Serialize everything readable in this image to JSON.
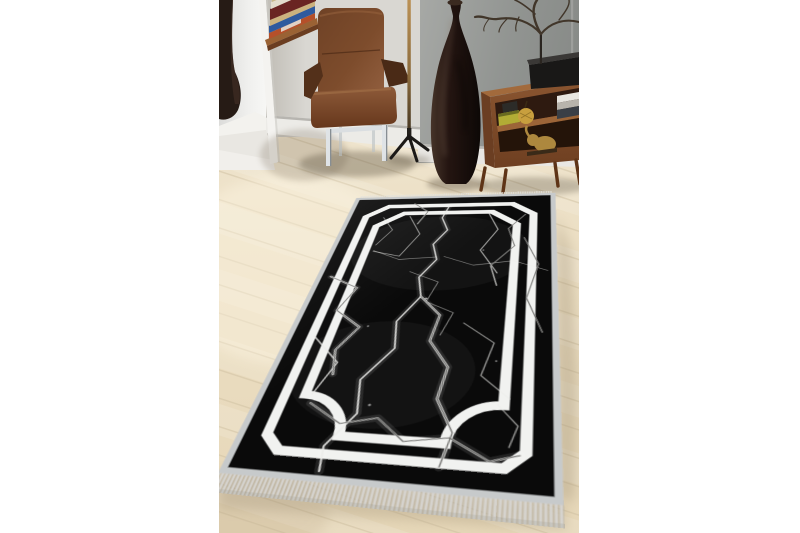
{
  "canvas": {
    "width": 800,
    "height": 533,
    "background": "#ffffff"
  },
  "photo": {
    "left": 219,
    "top": 0,
    "width": 360,
    "height": 533,
    "alt": "Black marble-pattern area rug with white double frame border and fringed ends, staged in a modern living room"
  },
  "palette": {
    "floor": "#e9dcbf",
    "floor_light": "#f2ebdb",
    "floor_seam": "#cfc1a2",
    "wall_back": "#d9d7d2",
    "wall_gray": "#8f928f",
    "wall_gray_light": "#a7a9a6",
    "window_light": "#f6f6f4",
    "white_wall": "#e9e7e2",
    "baseboard": "#efede9",
    "rug_black": "#0a0a0a",
    "rug_white": "#f1f2f0",
    "rug_binding": "#c7cacb",
    "fringe": "#d5d3cf",
    "leather": "#7c4c2d",
    "leather_dark": "#4a2b17",
    "chrome": "#dfe3e6",
    "wood": "#7d4a29",
    "wood_top": "#a26a3c",
    "floor_vase": "#1f1310",
    "brass": "#b08a50",
    "gold_decor": "#c89f3e"
  },
  "scene": {
    "objects": [
      {
        "name": "window-with-dark-vase",
        "label": "Bright window niche with dark decorative vase on white sill"
      },
      {
        "name": "wall-desk-with-books",
        "label": "Wall-mounted wooden desk with stacked books"
      },
      {
        "name": "leather-armchair",
        "label": "Brown leather armchair with chrome legs"
      },
      {
        "name": "floor-lamp-stand",
        "label": "Brass pole floor lamp with black tripod base"
      },
      {
        "name": "floor-vase",
        "label": "Tall dark bottle-shaped floor vase"
      },
      {
        "name": "branch-sculpture",
        "label": "Dry branch sculpture on a stand atop a black base"
      },
      {
        "name": "sideboard",
        "label": "Mid-century walnut sideboard with gold pear, box, books and elephant figurine"
      },
      {
        "name": "wood-floor",
        "label": "Light oak plank flooring laid diagonally"
      },
      {
        "name": "area-rug",
        "label": "Black marble-vein rug with double white frame border, chamfered corners, corner arcs and fringed short ends"
      }
    ]
  },
  "rug": {
    "field_color": "#0a0a0a",
    "frame_color": "#f1f2f0",
    "binding_color": "#c7cacb",
    "fringe_color": "#d5d3cf",
    "pattern": "white marble crack veins on black",
    "border_style": "double white band, chamfered top corners, quarter-arc bottom corners",
    "fringed_edges": 2
  }
}
